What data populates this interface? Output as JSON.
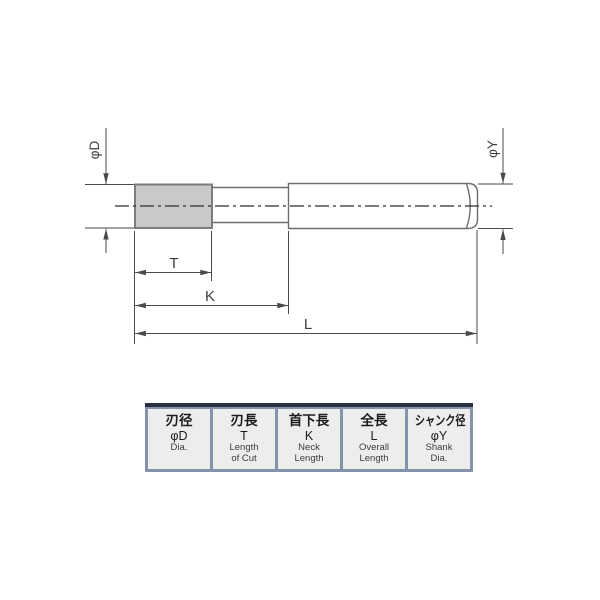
{
  "diagram": {
    "title": "tool-dimension-drawing",
    "labels": {
      "cut_diameter": "φD",
      "shank_diameter": "φY",
      "length_of_cut": "T",
      "neck_length": "K",
      "overall_length": "L"
    }
  },
  "table": {
    "columns": [
      {
        "jp": "刃径",
        "symbol": "φD",
        "en": [
          "Dia.",
          ""
        ]
      },
      {
        "jp": "刃長",
        "symbol": "T",
        "en": [
          "Length",
          "of Cut"
        ]
      },
      {
        "jp": "首下長",
        "symbol": "K",
        "en": [
          "Neck",
          "Length"
        ]
      },
      {
        "jp": "全長",
        "symbol": "L",
        "en": [
          "Overall",
          "Length"
        ]
      },
      {
        "jp": "シャンク径",
        "symbol": "φY",
        "en": [
          "Shank",
          "Dia."
        ]
      }
    ]
  },
  "colors": {
    "part_outline": "#6e6e6e",
    "cut_outline": "#7d7d7d",
    "cut_fill": "#c9c9c9",
    "dim": "#4a4a4a",
    "centerline": "#2f2f2f",
    "label_text": "#3d3d3d",
    "table_frame_top": "#2a3140",
    "table_frame": "#8593aa",
    "table_cell_bg": "#ededed",
    "table_text": "#1c1c1c",
    "table_text_muted": "#3c3c3c"
  }
}
